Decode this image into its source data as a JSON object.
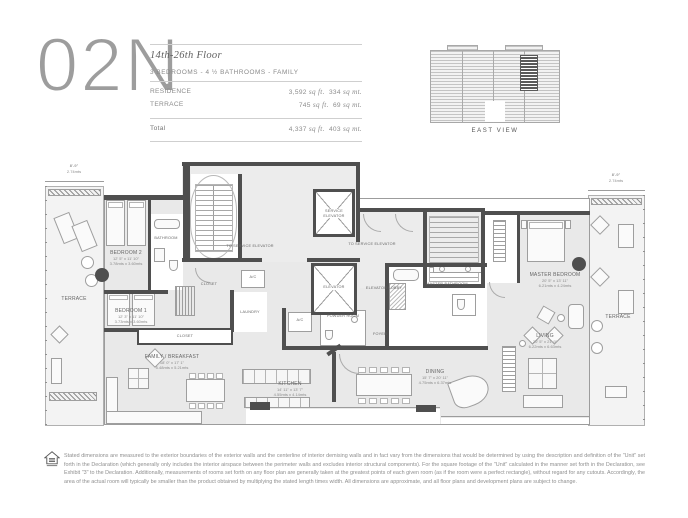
{
  "header": {
    "unit": "02N",
    "floor_range": "14th-26th Floor",
    "subtitle": "3 BEDROOMS - 4 ½ BATHROOMS - FAMILY",
    "rows": [
      {
        "label": "RESIDENCE",
        "sqft": "3,592",
        "sqft_unit": "sq ft.",
        "sqmt": "334",
        "sqmt_unit": "sq mt."
      },
      {
        "label": "TERRACE",
        "sqft": "745",
        "sqft_unit": "sq ft.",
        "sqmt": "69",
        "sqmt_unit": "sq mt."
      }
    ],
    "total": {
      "label": "Total",
      "sqft": "4,337",
      "sqft_unit": "sq ft.",
      "sqmt": "403",
      "sqmt_unit": "sq mt."
    }
  },
  "building": {
    "caption": "EAST VIEW"
  },
  "plan": {
    "dims": {
      "left_ft": "8'-9\"",
      "left_m": "2.74mts",
      "right_ft": "8'-9\"",
      "right_m": "2.74mts"
    },
    "rooms": {
      "bedroom2": {
        "name": "BEDROOM 2",
        "ft": "12' 5\" x 11' 10\"",
        "m": "3.78mts x 3.60mts"
      },
      "bathroom": {
        "name": "BATHROOM"
      },
      "bedroom1": {
        "name": "BEDROOM 1",
        "ft": "12' 3\" x 11' 10\"",
        "m": "3.73mts x 3.60mts"
      },
      "closet_corridor": {
        "name": "CLOSET"
      },
      "closet_strip": {
        "name": "CLOSET"
      },
      "laundry": {
        "name": "LAUNDRY"
      },
      "ac1": {
        "name": "A/C"
      },
      "ac2": {
        "name": "A/C"
      },
      "service_elevator": {
        "name": "SERVICE ELEVATOR"
      },
      "to_service_left": {
        "name": "TO SERVICE ELEVATOR"
      },
      "to_service_right": {
        "name": "TO SERVICE ELEVATOR"
      },
      "elevator": {
        "name": "ELEVATOR"
      },
      "elevator_lobby": {
        "name": "ELEVATOR LOBBY"
      },
      "powder": {
        "name": "POWDER ROOM"
      },
      "foyer": {
        "name": "FOYER"
      },
      "master_bathroom": {
        "name": "MASTER BATHROOM"
      },
      "master_bedroom": {
        "name": "MASTER BEDROOM",
        "ft": "20' 5\" x 13' 11\"",
        "m": "6.21mts x 4.24mts"
      },
      "family": {
        "name": "FAMILY / BREAKFAST",
        "ft": "18' 0\" x 17' 1\"",
        "m": "5.48mts x 5.21mts"
      },
      "kitchen": {
        "name": "KITCHEN",
        "ft": "14' 11\" x 13' 7\"",
        "m": "4.55mts x 4.14mts"
      },
      "dining": {
        "name": "DINING",
        "ft": "15' 7\" x 20' 11\"",
        "m": "4.75mts x 6.37mts"
      },
      "living": {
        "name": "LIVING",
        "ft": "20' 5\" x 21' 9\"",
        "m": "6.22mts x 6.63mts"
      },
      "terrace_left": {
        "name": "TERRACE"
      },
      "terrace_right": {
        "name": "TERRACE"
      }
    }
  },
  "footer": {
    "disclaimer": "Stated dimensions are measured to the exterior boundaries of the exterior walls and the centerline of interior demising walls and in fact vary from the dimensions that would be determined by using the description and definition of the \"Unit\" set forth in the Declaration (which generally only includes the interior airspace between the perimeter walls and excludes interior structural components).  For the square footage of the \"Unit\" calculated in the manner set forth in the Declaration, see Exhibit \"3\" to the Declaration.  Additionally, measurements of rooms set forth on any floor plan are generally taken at the greatest points of each given room (as if the room were a perfect rectangle), without regard for any cutouts.  Accordingly, the area of the actual room will typically be smaller than the product obtained by multiplying the stated length times width. All dimensions are approximate, and all floor plans and development plans are subject to change."
  }
}
